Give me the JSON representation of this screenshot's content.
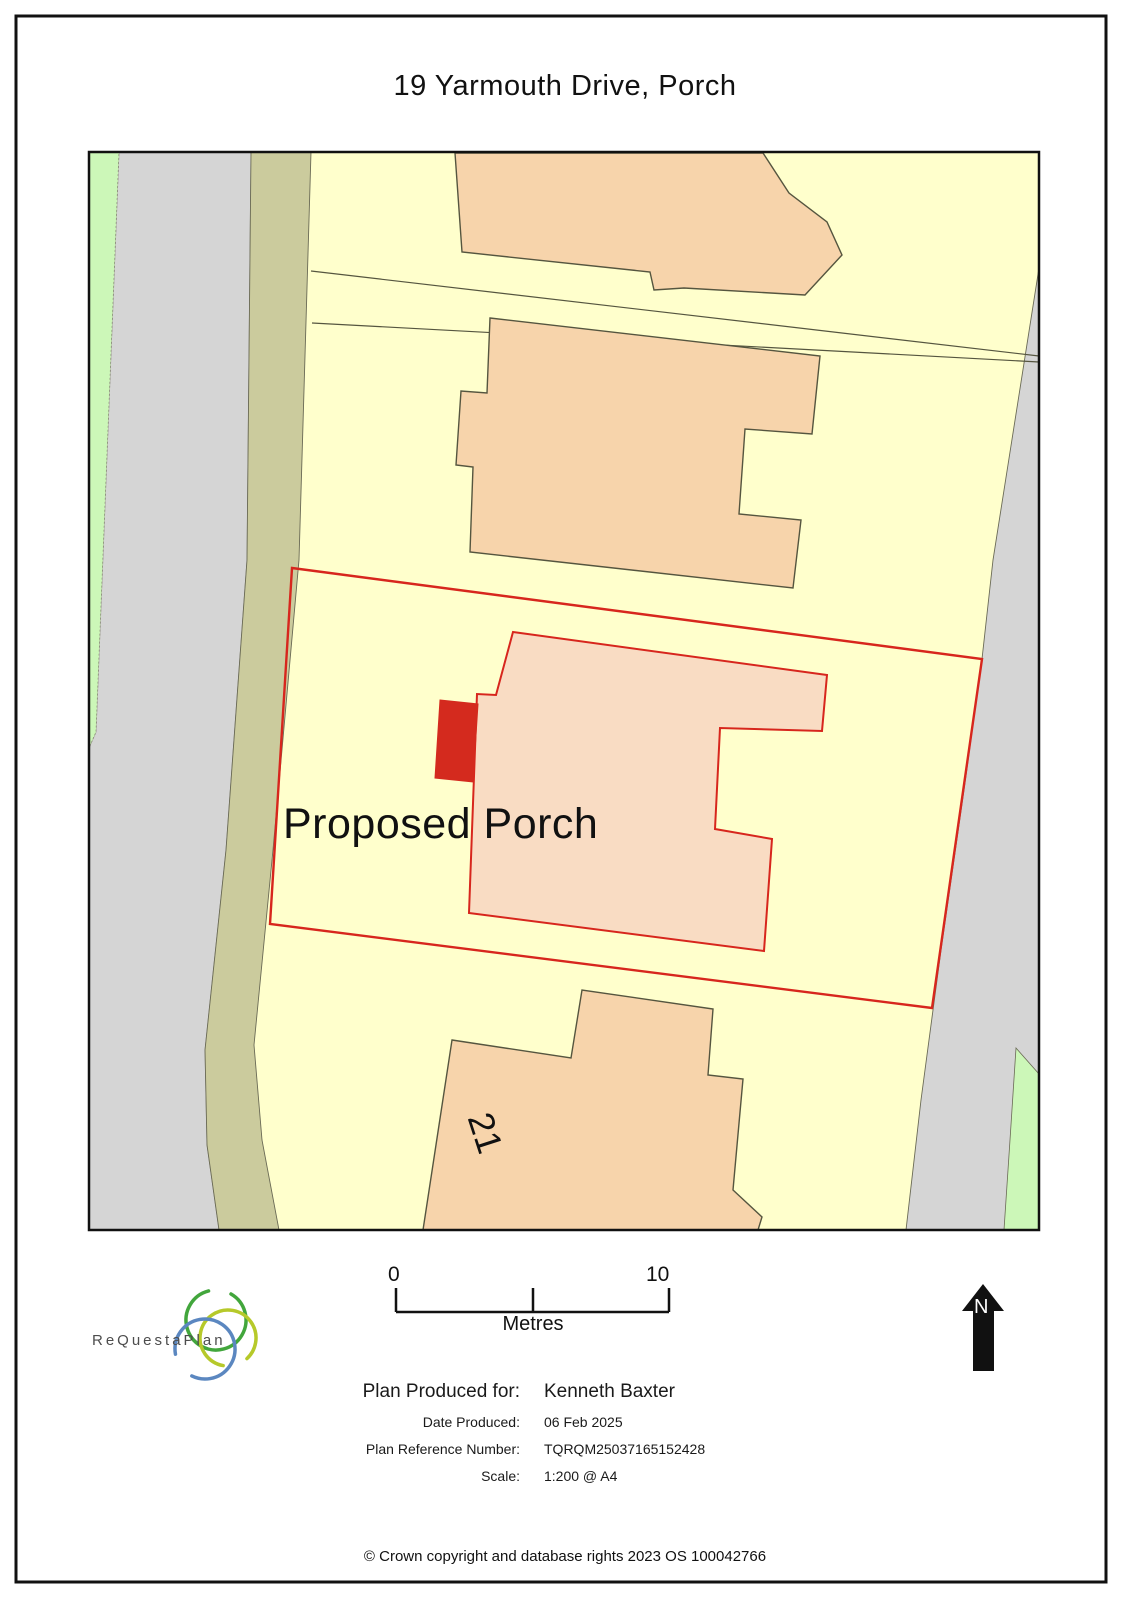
{
  "title": "19 Yarmouth Drive, Porch",
  "map": {
    "proposed_label": "Proposed Porch",
    "neighbour_number": "21"
  },
  "scale_bar": {
    "start": "0",
    "end": "10",
    "unit": "Metres"
  },
  "north_arrow": {
    "label": "N"
  },
  "logo": {
    "name": "ReQuestaPlan"
  },
  "plan_details": {
    "produced_for_label": "Plan Produced for:",
    "produced_for_value": "Kenneth Baxter",
    "date_label": "Date Produced:",
    "date_value": "06 Feb 2025",
    "reference_label": "Plan Reference Number:",
    "reference_value": "TQRQM25037165152428",
    "scale_label": "Scale:",
    "scale_value": "1:200 @ A4"
  },
  "copyright": "© Crown copyright and database rights 2023 OS 100042766",
  "colors": {
    "boundary_red": "#d7261d",
    "porch_red": "#d42a1e",
    "parcel_yellow": "#ffffcc",
    "building_peach": "#f7d4ab",
    "subject_building_peach": "#f9dcc3",
    "road_grey": "#d5d5d5",
    "verge_olive": "#cbcb9d",
    "verge_green": "#ccf7b8",
    "outline_dark": "#55553f",
    "logo_green": "#42a63c",
    "logo_lime": "#b6c92a",
    "logo_blue": "#5b87c0"
  }
}
